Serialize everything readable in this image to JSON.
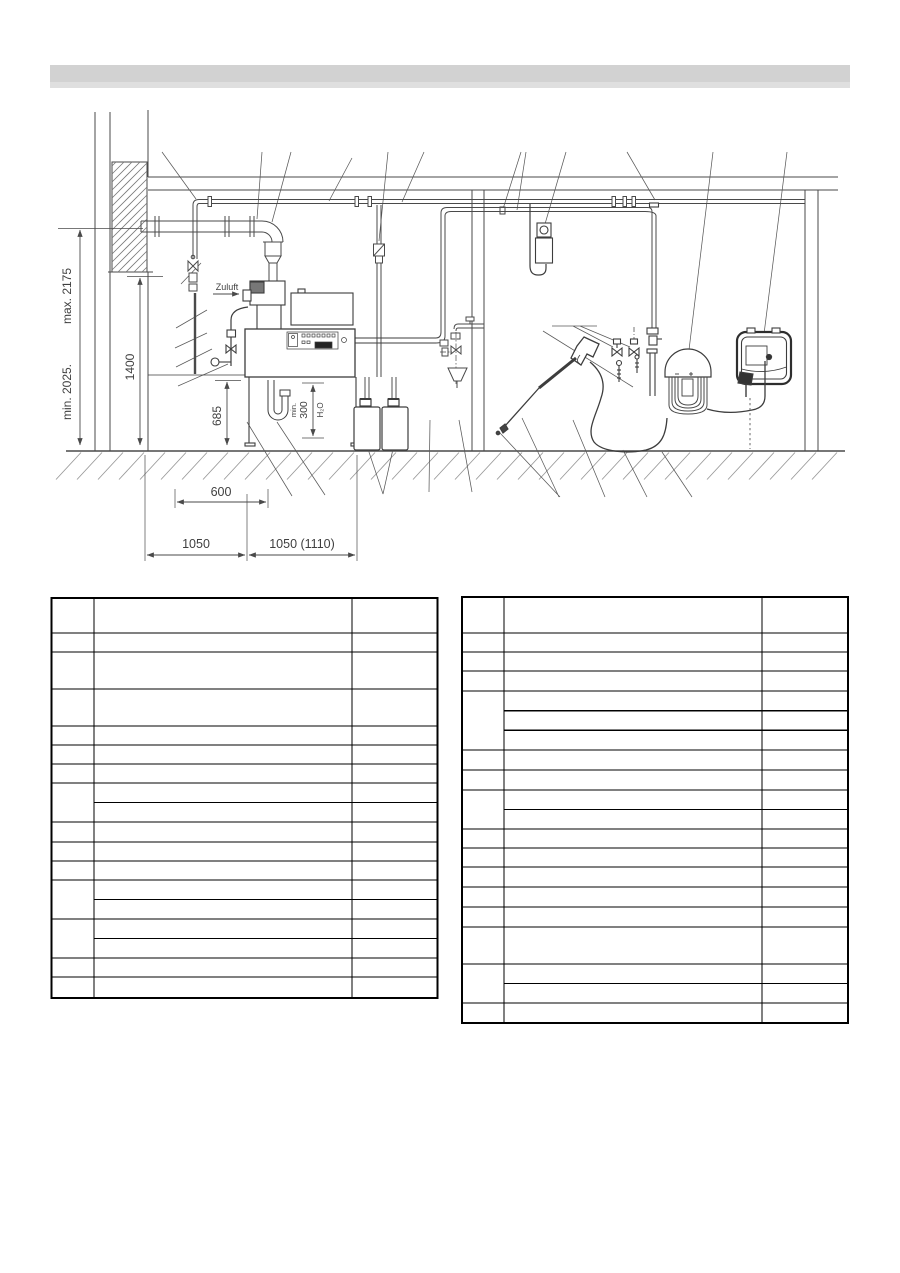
{
  "document": {
    "type": "installation-drawing-page",
    "title_bar_text": ""
  },
  "colors": {
    "title_bar": "#d2d2d2",
    "drawing_lines": "#4a4a4a",
    "table_border": "#000000",
    "page_background": "#ffffff"
  },
  "diagram": {
    "labels": {
      "air_supply": "Zuluft",
      "max_height": "max. 2175",
      "min_height": "min. 2025.",
      "height_1400": "1400",
      "height_685": "685",
      "width_600": "600",
      "width_1050": "1050",
      "width_1050_alt": "1050 (1110)",
      "siphon_min": "min.",
      "siphon_300": "300",
      "siphon_h2o": "H₂O"
    }
  },
  "tables": {
    "left": {
      "columns": 3,
      "rows": 15
    },
    "right": {
      "columns": 3,
      "rows": 16
    }
  }
}
